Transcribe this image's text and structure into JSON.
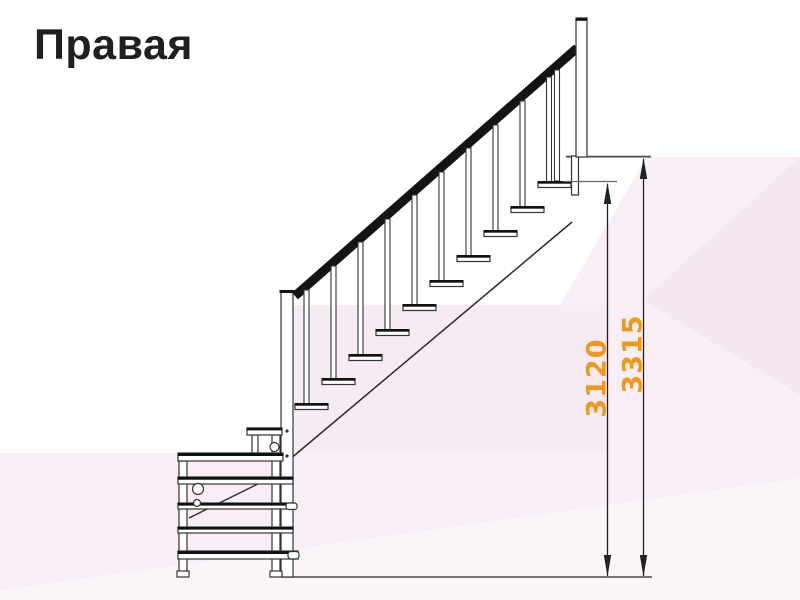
{
  "title": "Правая",
  "diagram": {
    "type": "staircase-side-elevation",
    "main_flight_treads": 10,
    "lower_section_treads": 5
  },
  "dimensions": [
    {
      "id": "height-3120",
      "value": "3120"
    },
    {
      "id": "height-3315",
      "value": "3315"
    }
  ],
  "colors": {
    "dimension_label": "#f0981c",
    "title_text": "#1f1f1f",
    "drawing_line": "#2a2a2a",
    "handrail": "#141414",
    "background_tint": "#f8eef5"
  }
}
